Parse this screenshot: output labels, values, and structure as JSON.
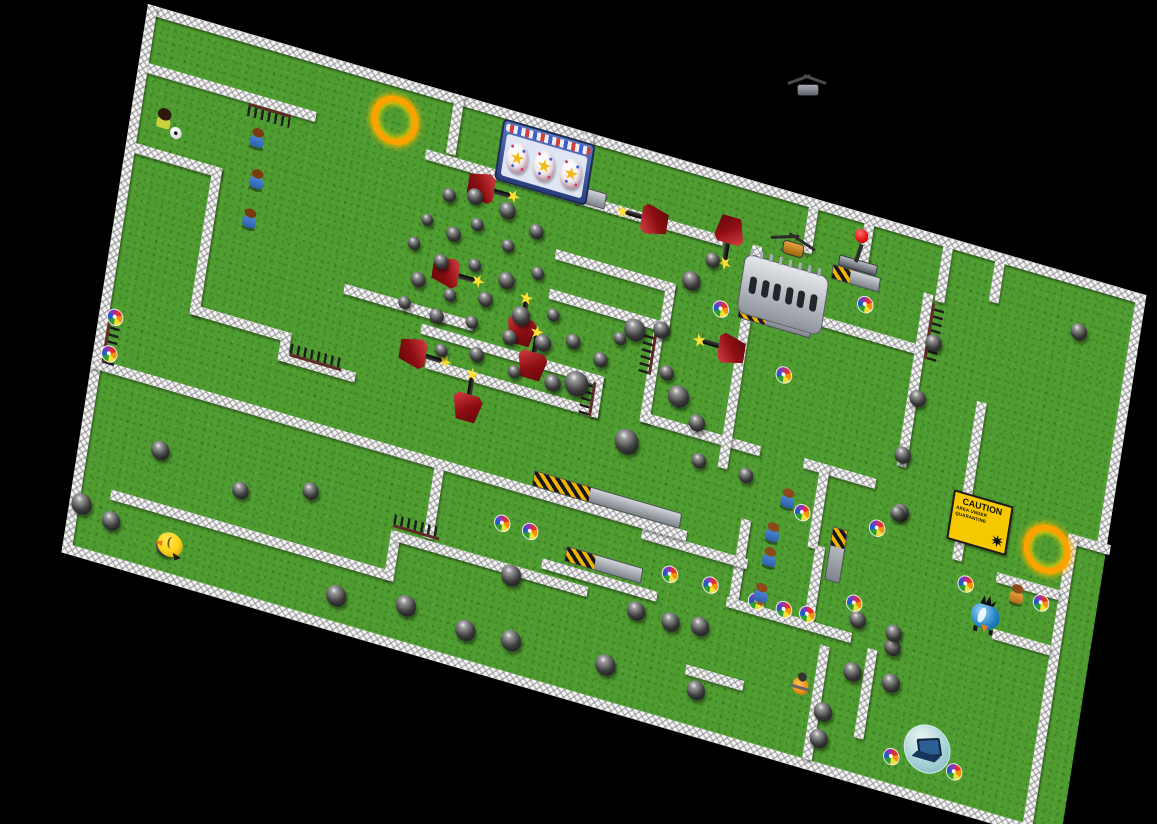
{
  "scene": {
    "type": "maze-game-map",
    "background": "#000000"
  },
  "map": {
    "width": 1040,
    "height": 555,
    "transform": "matrix(0.96,0.28,-0.156,0.988,148,4)",
    "grass_color": "#4f9d30",
    "wall_color": "#f5f5f5"
  },
  "colors": {
    "cannon": "#a01016",
    "spark": "#ffe135",
    "bomb": "#1a1a1a",
    "fire_ring": "#ffa200",
    "caution_bg": "#f6c800",
    "platform": "#9aa0a8",
    "hazard_yellow": "#f0b400",
    "hazard_black": "#151515"
  },
  "caution": {
    "title": "CAUTION",
    "line1": "AREA UNDER",
    "line2": "QUARANTINE"
  },
  "walls": [
    [
      0,
      0,
      1040,
      10
    ],
    [
      0,
      0,
      10,
      555
    ],
    [
      0,
      545,
      1010,
      10
    ],
    [
      1030,
      0,
      10,
      260
    ],
    [
      1000,
      252,
      44,
      10
    ],
    [
      1000,
      252,
      10,
      303
    ],
    [
      10,
      57,
      175,
      10
    ],
    [
      10,
      138,
      90,
      10
    ],
    [
      90,
      138,
      10,
      150
    ],
    [
      90,
      278,
      100,
      10
    ],
    [
      185,
      278,
      10,
      30
    ],
    [
      185,
      298,
      80,
      10
    ],
    [
      240,
      215,
      135,
      10
    ],
    [
      320,
      0,
      10,
      60
    ],
    [
      300,
      62,
      160,
      10
    ],
    [
      455,
      0,
      10,
      72
    ],
    [
      465,
      62,
      145,
      10
    ],
    [
      445,
      122,
      125,
      10
    ],
    [
      445,
      162,
      125,
      10
    ],
    [
      560,
      122,
      10,
      50
    ],
    [
      323,
      232,
      190,
      10
    ],
    [
      333,
      264,
      180,
      10
    ],
    [
      503,
      232,
      10,
      42
    ],
    [
      555,
      170,
      10,
      95
    ],
    [
      555,
      255,
      125,
      10
    ],
    [
      640,
      62,
      10,
      225
    ],
    [
      690,
      10,
      10,
      45
    ],
    [
      748,
      10,
      10,
      40
    ],
    [
      715,
      112,
      108,
      10
    ],
    [
      818,
      60,
      10,
      175
    ],
    [
      830,
      10,
      10,
      55
    ],
    [
      884,
      10,
      10,
      40
    ],
    [
      888,
      150,
      10,
      160
    ],
    [
      935,
      310,
      65,
      10
    ],
    [
      940,
      366,
      60,
      10
    ],
    [
      725,
      254,
      75,
      10
    ],
    [
      742,
      254,
      10,
      85
    ],
    [
      750,
      335,
      10,
      80
    ],
    [
      672,
      330,
      10,
      85
    ],
    [
      670,
      410,
      130,
      10
    ],
    [
      575,
      368,
      110,
      10
    ],
    [
      480,
      425,
      120,
      10
    ],
    [
      0,
      358,
      620,
      10
    ],
    [
      358,
      368,
      10,
      70
    ],
    [
      40,
      480,
      290,
      10
    ],
    [
      325,
      440,
      10,
      50
    ],
    [
      330,
      440,
      200,
      10
    ],
    [
      770,
      430,
      10,
      115
    ],
    [
      818,
      420,
      10,
      90
    ],
    [
      640,
      487,
      60,
      10
    ]
  ],
  "spikes": [
    {
      "x": 116,
      "y": 67,
      "len": 44,
      "dir": "down"
    },
    {
      "x": 196,
      "y": 288,
      "len": 54,
      "dir": "up"
    },
    {
      "x": 546,
      "y": 175,
      "len": 42,
      "dir": "left"
    },
    {
      "x": 493,
      "y": 240,
      "len": 34,
      "dir": "left"
    },
    {
      "x": 326,
      "y": 424,
      "len": 48,
      "dir": "up"
    },
    {
      "x": 10,
      "y": 308,
      "len": 52,
      "dir": "right"
    },
    {
      "x": 828,
      "y": 68,
      "len": 56,
      "dir": "right"
    }
  ],
  "platforms": [
    {
      "x": 373,
      "y": 54,
      "w": 112,
      "h": 14,
      "v": false
    },
    {
      "x": 723,
      "y": 58,
      "w": 48,
      "h": 13,
      "v": false
    },
    {
      "x": 636,
      "y": 122,
      "w": 74,
      "h": 13,
      "v": false
    },
    {
      "x": 458,
      "y": 342,
      "w": 152,
      "h": 14,
      "v": false
    },
    {
      "x": 502,
      "y": 406,
      "w": 78,
      "h": 14,
      "v": false
    },
    {
      "x": 764,
      "y": 312,
      "w": 14,
      "h": 52,
      "v": true
    }
  ],
  "cannons": [
    {
      "x": 370,
      "y": 83,
      "dir": "right"
    },
    {
      "x": 529,
      "y": 67,
      "dir": "left"
    },
    {
      "x": 615,
      "y": 64,
      "dir": "down"
    },
    {
      "x": 348,
      "y": 175,
      "dir": "right"
    },
    {
      "x": 423,
      "y": 202,
      "dir": "up"
    },
    {
      "x": 439,
      "y": 232,
      "dir": "up"
    },
    {
      "x": 328,
      "y": 262,
      "dir": "right"
    },
    {
      "x": 381,
      "y": 291,
      "dir": "up"
    },
    {
      "x": 626,
      "y": 170,
      "dir": "left"
    }
  ],
  "bombs": [
    [
      330,
      100,
      14
    ],
    [
      356,
      94,
      16
    ],
    [
      390,
      98,
      17
    ],
    [
      362,
      120,
      13
    ],
    [
      340,
      136,
      15
    ],
    [
      312,
      130,
      12
    ],
    [
      396,
      132,
      13
    ],
    [
      422,
      110,
      15
    ],
    [
      302,
      156,
      13
    ],
    [
      332,
      166,
      15
    ],
    [
      366,
      160,
      13
    ],
    [
      400,
      166,
      17
    ],
    [
      430,
      150,
      13
    ],
    [
      312,
      190,
      15
    ],
    [
      346,
      196,
      13
    ],
    [
      382,
      190,
      15
    ],
    [
      420,
      196,
      19
    ],
    [
      452,
      186,
      13
    ],
    [
      302,
      216,
      13
    ],
    [
      336,
      220,
      15
    ],
    [
      372,
      216,
      13
    ],
    [
      412,
      220,
      15
    ],
    [
      446,
      216,
      17
    ],
    [
      476,
      206,
      15
    ],
    [
      486,
      246,
      25
    ],
    [
      462,
      252,
      17
    ],
    [
      422,
      252,
      13
    ],
    [
      382,
      246,
      15
    ],
    [
      346,
      252,
      13
    ],
    [
      506,
      216,
      15
    ],
    [
      522,
      190,
      13
    ],
    [
      536,
      178,
      22
    ],
    [
      562,
      170,
      17
    ],
    [
      584,
      114,
      19
    ],
    [
      602,
      88,
      15
    ],
    [
      574,
      210,
      15
    ],
    [
      590,
      230,
      22
    ],
    [
      612,
      250,
      17
    ],
    [
      545,
      288,
      25
    ],
    [
      620,
      286,
      15
    ],
    [
      82,
      428,
      19
    ],
    [
      12,
      502,
      21
    ],
    [
      44,
      510,
      19
    ],
    [
      102,
      520,
      19
    ],
    [
      168,
      444,
      17
    ],
    [
      238,
      425,
      17
    ],
    [
      280,
      519,
      21
    ],
    [
      351,
      509,
      21
    ],
    [
      414,
      516,
      21
    ],
    [
      461,
      513,
      21
    ],
    [
      451,
      450,
      21
    ],
    [
      559,
      510,
      21
    ],
    [
      581,
      449,
      19
    ],
    [
      617,
      450,
      19
    ],
    [
      647,
      446,
      19
    ],
    [
      653,
      509,
      19
    ],
    [
      669,
      287,
      15
    ],
    [
      835,
      106,
      17
    ],
    [
      828,
      164,
      17
    ],
    [
      822,
      223,
      17
    ],
    [
      829,
      279,
      17
    ],
    [
      978,
      54,
      17
    ],
    [
      806,
      447,
      19
    ],
    [
      846,
      447,
      19
    ],
    [
      842,
      412,
      17
    ],
    [
      783,
      494,
      19
    ],
    [
      783,
      521,
      19
    ],
    [
      826,
      281,
      15
    ],
    [
      803,
      395,
      17
    ],
    [
      841,
      398,
      17
    ]
  ],
  "pinwheels": [
    [
      16,
      312
    ],
    [
      16,
      349
    ],
    [
      434,
      402
    ],
    [
      463,
      402
    ],
    [
      609,
      404
    ],
    [
      651,
      403
    ],
    [
      699,
      406
    ],
    [
      728,
      406
    ],
    [
      752,
      404
    ],
    [
      731,
      307
    ],
    [
      808,
      301
    ],
    [
      797,
      380
    ],
    [
      905,
      330
    ],
    [
      983,
      327
    ],
    [
      858,
      518
    ],
    [
      923,
      515
    ],
    [
      761,
      88
    ],
    [
      691,
      179
    ],
    [
      618,
      133
    ]
  ],
  "fire_rings": [
    [
      258,
      37
    ],
    [
      975,
      268
    ]
  ],
  "characters": {
    "kids_top": [
      [
        130,
        100
      ],
      [
        136,
        140
      ],
      [
        135,
        180
      ]
    ],
    "kids_column": [
      [
        715,
        299
      ],
      [
        705,
        336
      ],
      [
        706,
        361
      ],
      [
        703,
        398
      ]
    ],
    "kid_right": [
      958,
      327
    ],
    "afro_kid": [
      34,
      108
    ],
    "soccer_ball": [
      48,
      117
    ],
    "duck": [
      107,
      517
    ],
    "bluebird": [
      930,
      354
    ],
    "scooter_kid": [
      757,
      475
    ]
  },
  "objects": {
    "egg_machine": {
      "x": 372,
      "y": 10,
      "eggs": 3
    },
    "crusher": {
      "x": 634,
      "y": 72
    },
    "helicopter": {
      "x": 658,
      "y": 42
    },
    "lever": {
      "x": 747,
      "y": 28
    },
    "caution_sign": {
      "x": 879,
      "y": 242
    },
    "laptop_bubble": {
      "x": 892,
      "y": 500
    },
    "drone_screen": {
      "x": 790,
      "y": 78
    }
  }
}
